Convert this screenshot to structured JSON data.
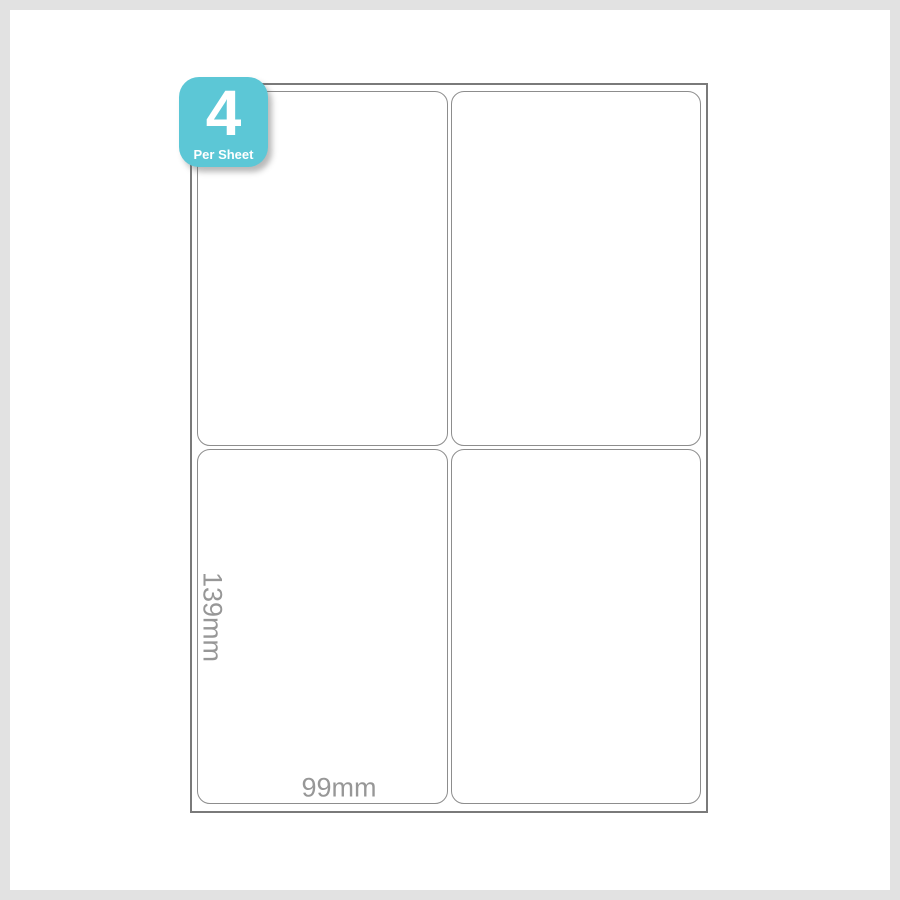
{
  "badge": {
    "count": "4",
    "caption": "Per Sheet",
    "background_color": "#5cc7d6",
    "text_color": "#ffffff"
  },
  "sheet": {
    "labels_per_sheet": 4,
    "rows": 2,
    "columns": 2,
    "background_color": "#ffffff",
    "outline_color": "#7a7a7a",
    "label_outline_color": "#8d8d8d"
  },
  "dimensions": {
    "label_height": "139mm",
    "label_width": "99mm",
    "text_color": "#979797"
  },
  "frame": {
    "border_color": "#e2e2e2"
  }
}
